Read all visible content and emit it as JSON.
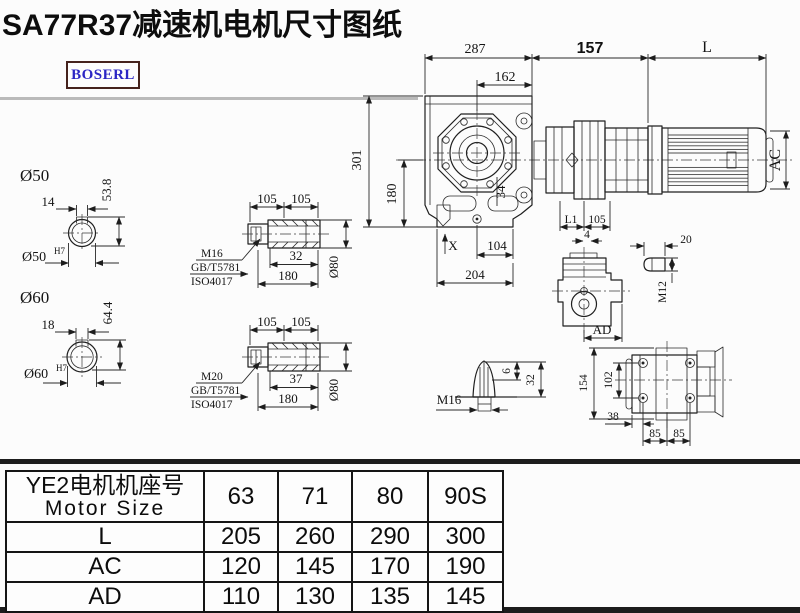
{
  "page": {
    "title": "SA77R37减速机电机尺寸图纸",
    "brand": "BOSERL"
  },
  "colors": {
    "ink": "#1f1f1f",
    "brand_text": "#2b25c4",
    "brand_border": "#46231d",
    "background": "#fcfcfc"
  },
  "main_view": {
    "d287": "287",
    "d162": "162",
    "d157": "157",
    "dL": "L",
    "dAC": "AC",
    "d301": "301",
    "d180": "180",
    "d34": "34",
    "dX": "X",
    "d104": "104",
    "d204": "204"
  },
  "input_dims": {
    "l1": "L1",
    "d105": "105",
    "d4": "4"
  },
  "side_view": {
    "ad": "AD"
  },
  "key_detail": {
    "d20": "20",
    "m12": "M12"
  },
  "shaft_50": {
    "title": "Ø50",
    "key_w": "14",
    "h": "53.8",
    "bore": "Ø50",
    "tol": "H7"
  },
  "shaft_60": {
    "title": "Ø60",
    "key_w": "18",
    "h": "64.4",
    "bore": "Ø60",
    "tol": "H7"
  },
  "bushing_top": {
    "thread": "M16",
    "std1": "GB/T5781",
    "std2": "ISO4017",
    "seg_a": "105",
    "seg_b": "105",
    "depth": "32",
    "length": "180",
    "dia": "Ø80"
  },
  "bushing_bottom": {
    "thread": "M20",
    "std1": "GB/T5781",
    "std2": "ISO4017",
    "seg_a": "105",
    "seg_b": "105",
    "depth": "37",
    "length": "180",
    "dia": "Ø80"
  },
  "breather": {
    "thread": "M16",
    "d6": "6",
    "d32": "32"
  },
  "rear_view": {
    "d154": "154",
    "d102": "102",
    "d38": "38",
    "d85a": "85",
    "d85b": "85"
  },
  "table": {
    "header_cn": "YE2电机机座号",
    "header_en": "Motor Size",
    "sizes": [
      "63",
      "71",
      "80",
      "90S"
    ],
    "rows": [
      {
        "label": "L",
        "values": [
          "205",
          "260",
          "290",
          "300"
        ]
      },
      {
        "label": "AC",
        "values": [
          "120",
          "145",
          "170",
          "190"
        ]
      },
      {
        "label": "AD",
        "values": [
          "110",
          "130",
          "135",
          "145"
        ]
      }
    ]
  }
}
